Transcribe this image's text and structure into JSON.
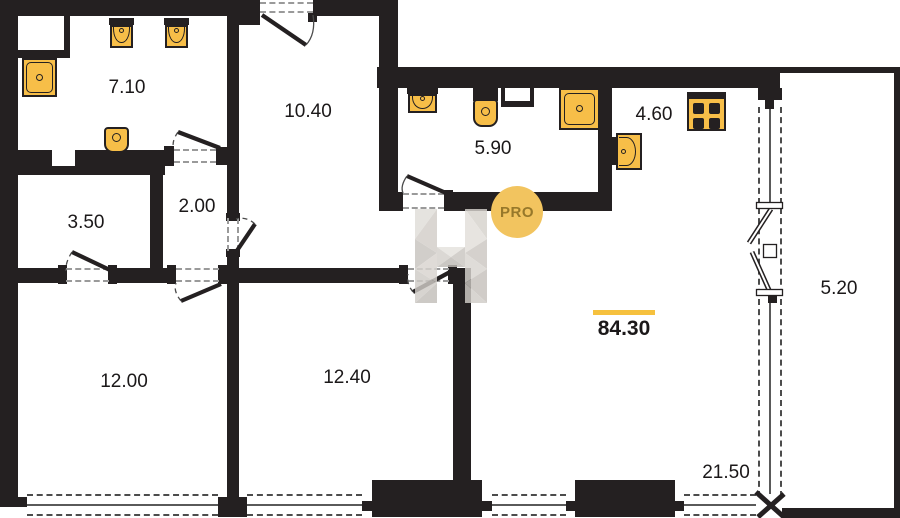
{
  "watermark": {
    "badge": "PRO"
  },
  "total": {
    "label": "84.30"
  },
  "rooms": [
    {
      "name": "bathroom-top-left",
      "label": "7.10"
    },
    {
      "name": "entrance-hall",
      "label": "10.40"
    },
    {
      "name": "bathroom-center",
      "label": "5.90"
    },
    {
      "name": "kitchen",
      "label": "4.60"
    },
    {
      "name": "closet",
      "label": "3.50"
    },
    {
      "name": "hallway-nook",
      "label": "2.00"
    },
    {
      "name": "bedroom-left",
      "label": "12.00"
    },
    {
      "name": "bedroom-center",
      "label": "12.40"
    },
    {
      "name": "balcony",
      "label": "5.20"
    },
    {
      "name": "living-room",
      "label": "21.50"
    }
  ],
  "colors": {
    "wall": "#242021",
    "fixture": "#F7BE48",
    "badge_circle": "#F2C45F",
    "accent_bar": "#F6C13E"
  }
}
